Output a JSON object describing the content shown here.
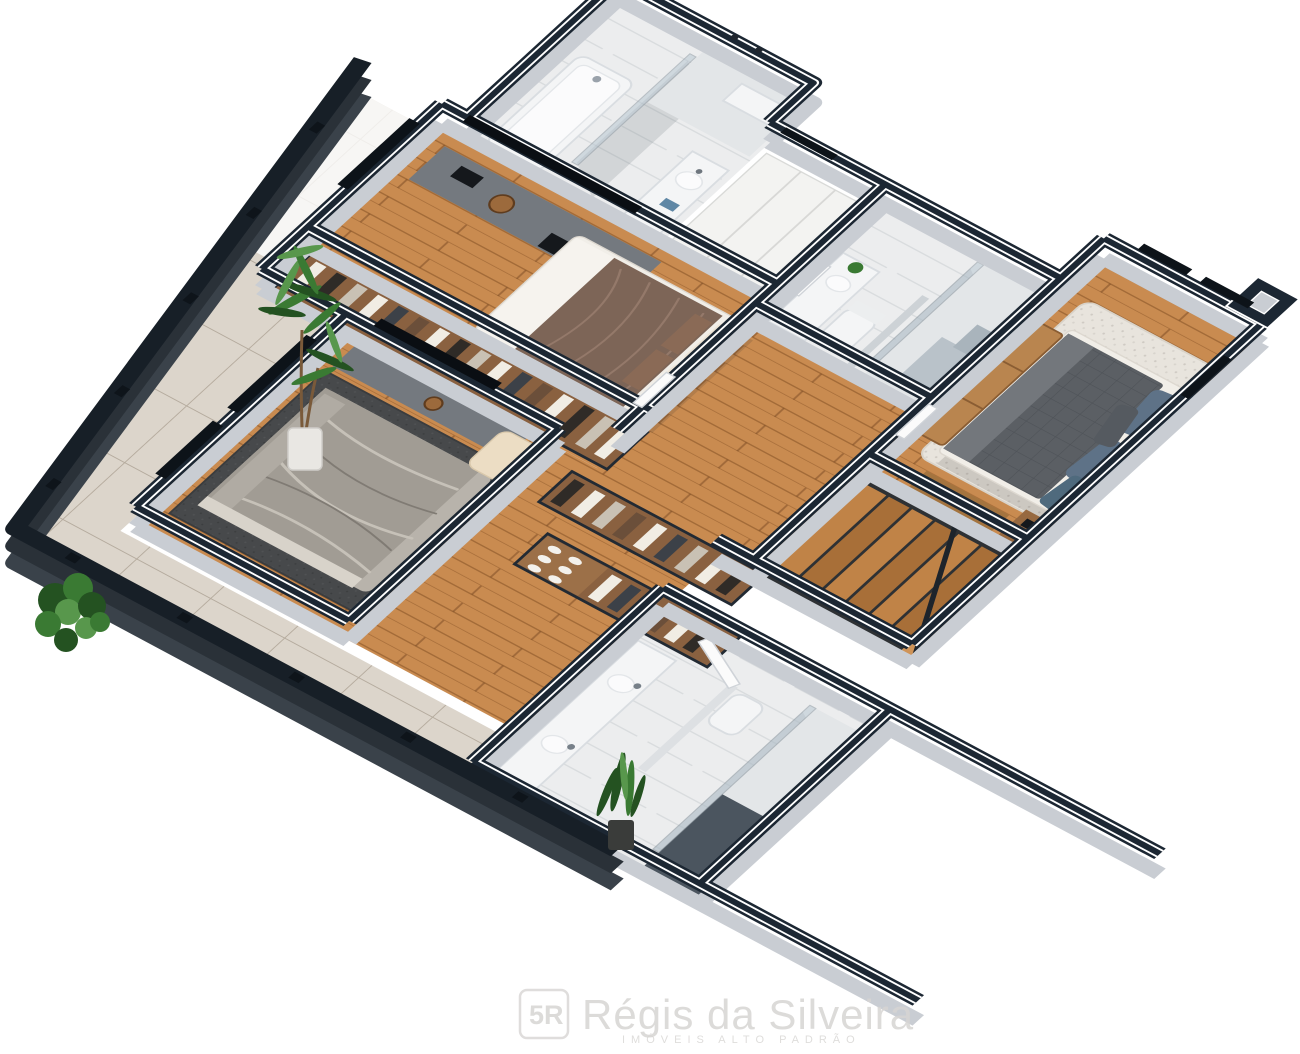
{
  "watermark": {
    "logo_letters": "5R",
    "title": "Régis da Silveira",
    "subtitle": "IMÓVEIS ALTO PADRÃO"
  },
  "palette": {
    "wallTop": "#1c2733",
    "wallTrim": "#ffffff",
    "wallBody": "#c9cdd3",
    "parapet": "#171f27",
    "parapetBody": "#3a424a",
    "wood": "#c98b50",
    "tile": "#dcd5cb",
    "marble": "#ecedee",
    "rugDark": "#47494b",
    "rugShag": "#e8e4dd",
    "bedBrown": "#7d6557",
    "bedWhite": "#f1eee8",
    "quilt": "#5b5f64",
    "headboard": "#3c4f63",
    "pillowBlue": "#5e7287",
    "bench": "#b9854f",
    "armchair": "#ecddc4",
    "console": "#74797f",
    "closetWood": "#8a6140",
    "stairWood": "#c08347",
    "glass": "#b9c8d2",
    "fixture": "#f4f5f6",
    "plant": "#3a7a33",
    "plantDark": "#245221",
    "watermark": "#d7d5d3"
  },
  "scene": {
    "type": "3d-isometric-floor-plan",
    "rooms": [
      {
        "name": "bathroom-top",
        "items": [
          "bathtub",
          "vanity-sink",
          "glass-shower"
        ]
      },
      {
        "name": "master-bedroom",
        "items": [
          "double-bed-brown",
          "dresser-console",
          "tv-panel"
        ]
      },
      {
        "name": "ensuite-bathroom",
        "items": [
          "toilet",
          "vanity-sink",
          "glass-shower",
          "small-plant"
        ]
      },
      {
        "name": "bedroom-right",
        "items": [
          "double-bed-gray-quilt",
          "blue-headboard",
          "rattan-bench",
          "shag-rug",
          "nightstand"
        ]
      },
      {
        "name": "bedroom-left",
        "items": [
          "double-bed-gray",
          "dark-rug",
          "cream-armchair",
          "tv-console"
        ]
      },
      {
        "name": "walk-in-closet",
        "items": [
          "wardrobe-row",
          "closet-islands",
          "shoe-cubbies"
        ]
      },
      {
        "name": "staircase",
        "items": [
          "wood-steps",
          "landing",
          "handrail"
        ]
      },
      {
        "name": "bathroom-bottom",
        "items": [
          "double-vanity",
          "toilet",
          "glass-shower",
          "white-door"
        ]
      }
    ],
    "exterior": [
      "tiled-terrace",
      "dark-parapet-walls",
      "tall-potted-plant",
      "corner-bush",
      "snake-plant"
    ]
  }
}
